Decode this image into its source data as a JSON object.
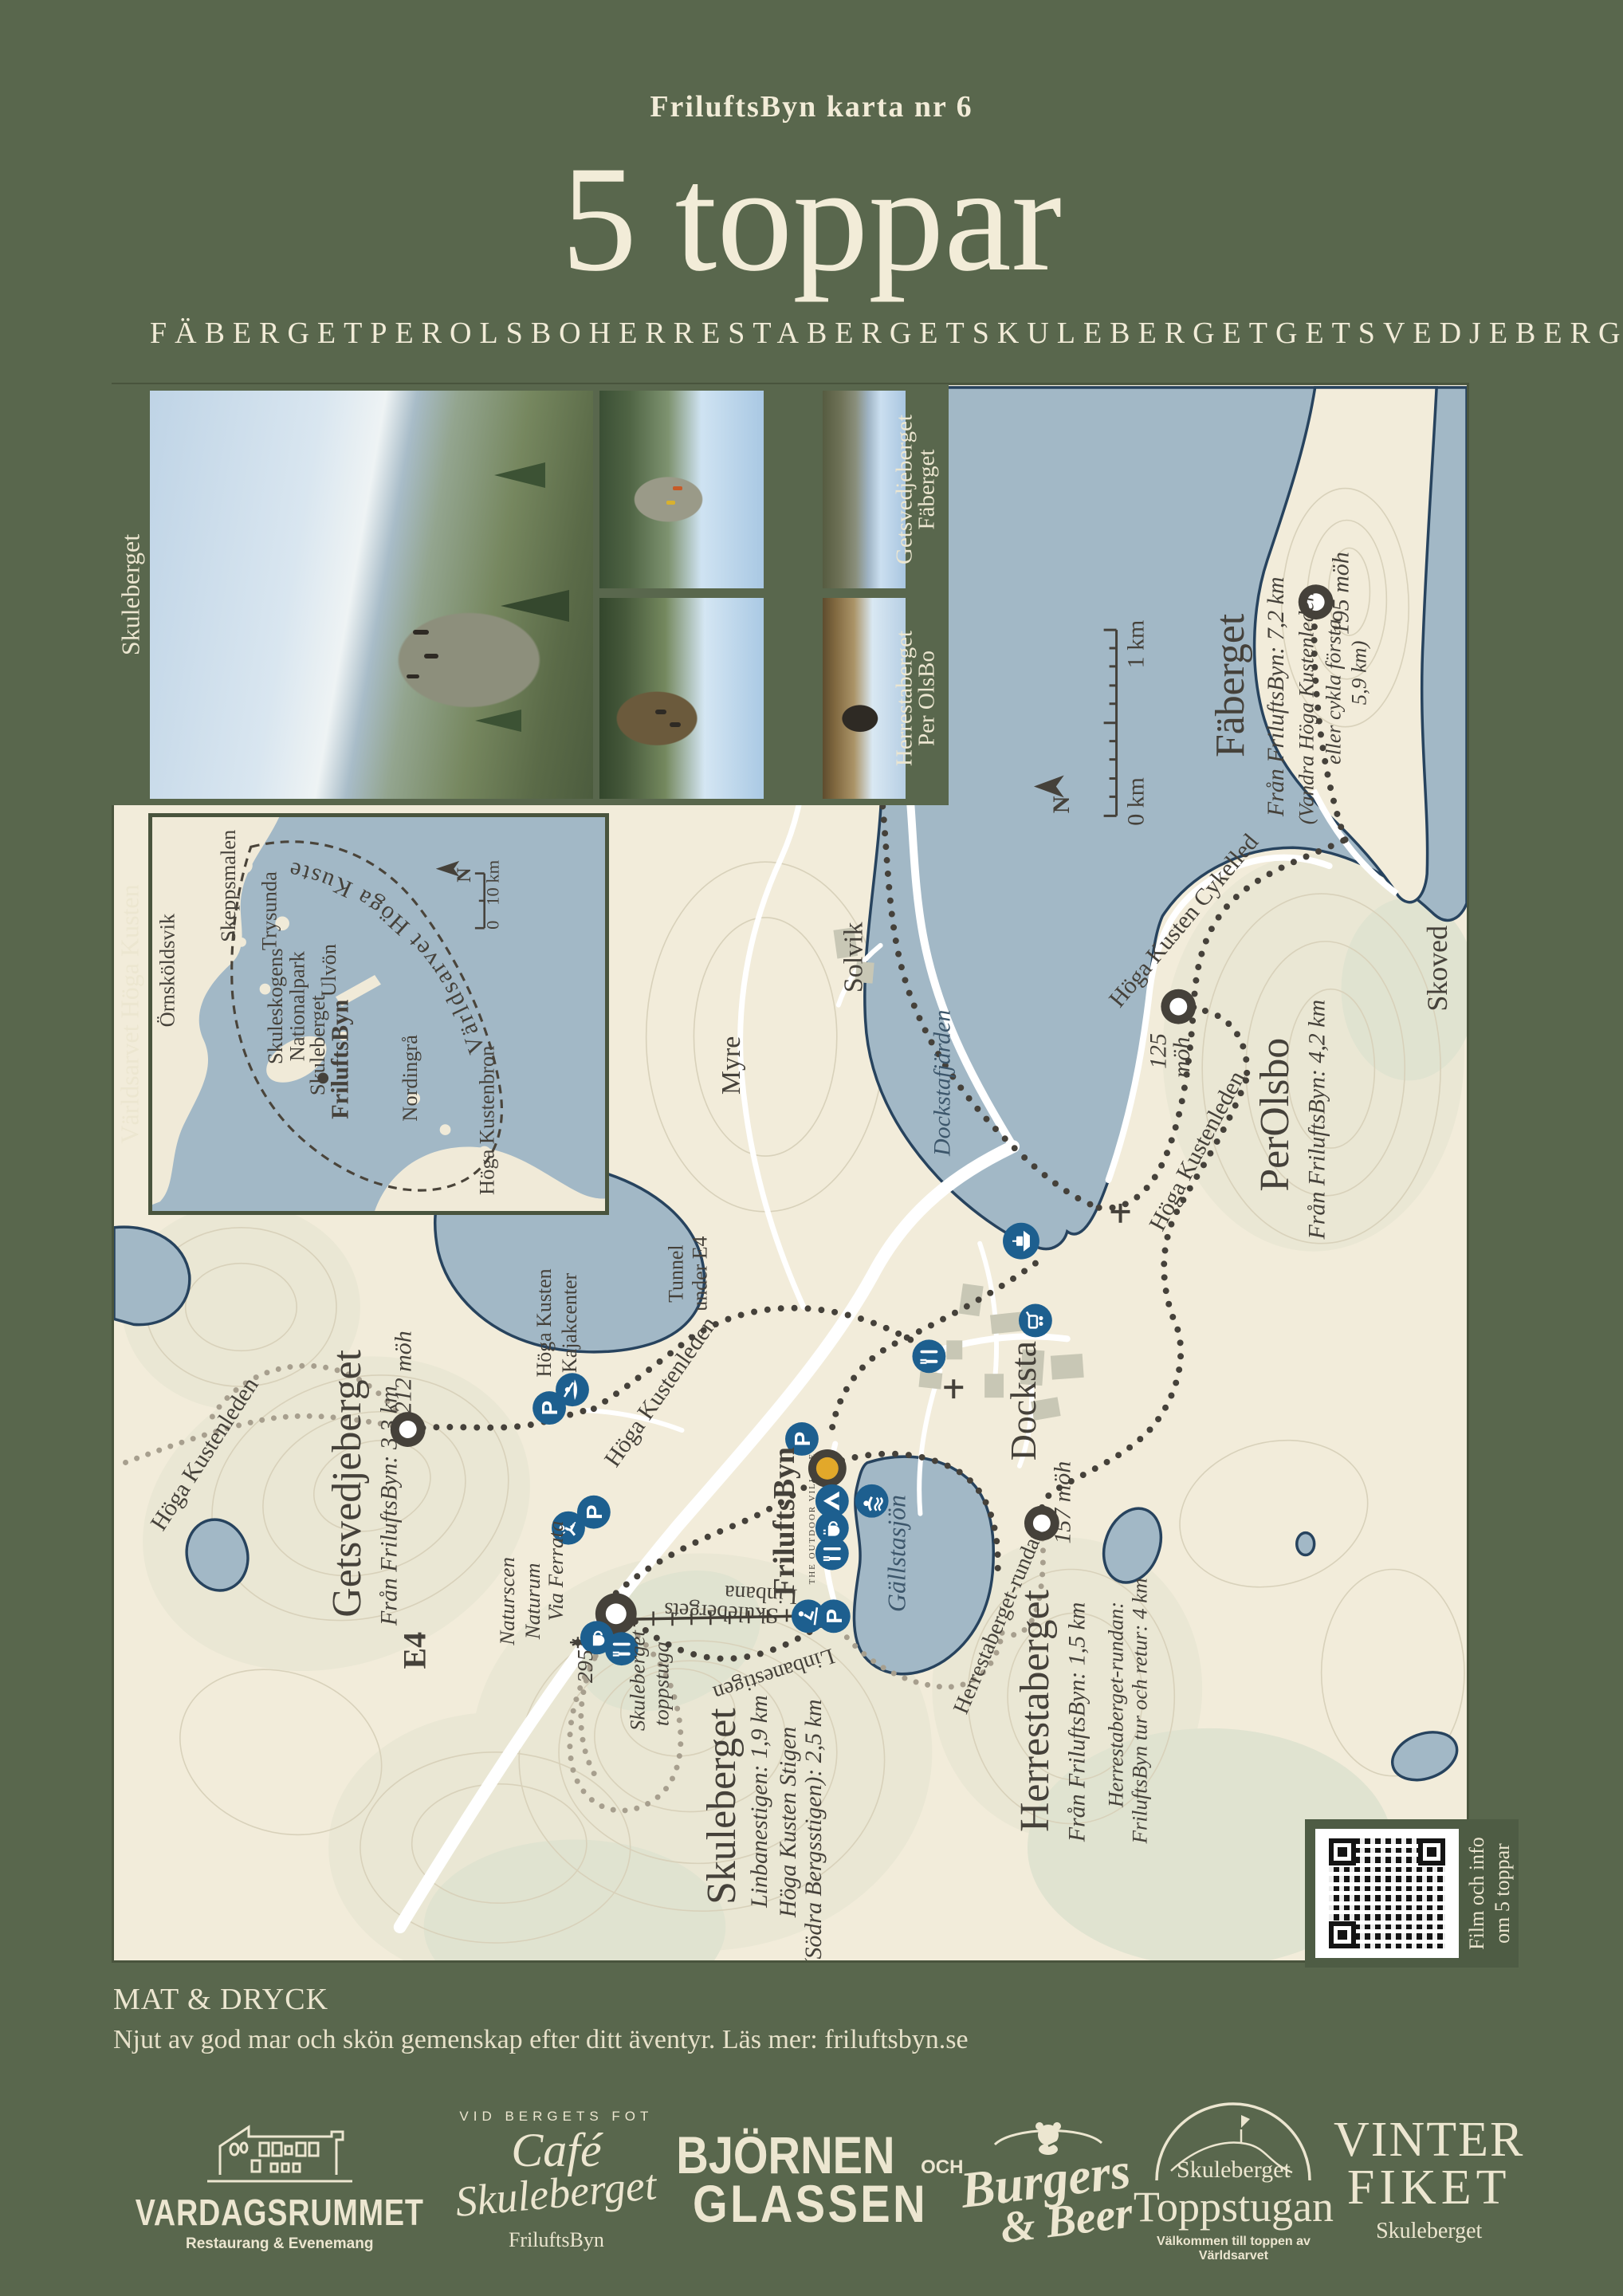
{
  "poster": {
    "kicker": "FriluftsByn karta nr 6",
    "title": "5 toppar",
    "peaks": [
      "FÄBERGET",
      "PEROLSBO",
      "HERRESTABERGET",
      "SKULEBERGET",
      "GETSVEDJEBERGET"
    ],
    "colors": {
      "green": "#59674d",
      "cream": "#efe9d3",
      "land": "#f2ecda",
      "water": "#a2b8c6",
      "trail": "#45413a",
      "blue_icon": "#1d5f8f",
      "gold": "#e2a82a"
    }
  },
  "photos": {
    "side_label": "Skuleberget",
    "col1_top": "Getsvedjeberget",
    "col1_bottom": "Herrestaberget",
    "col2_top": "Fäberget",
    "col2_bottom": "Per OlsBo"
  },
  "inset": {
    "side_label": "Världsarvet Höga Kusten",
    "heritage": "Världsarvet Höga Kusten",
    "ornskoldsvik": "Örnsköldsvik",
    "skeppsmalen": "Skeppsmalen",
    "trysunda": "Trysunda",
    "ulvon": "Ulvön",
    "skuleskogens1": "Skuleskogens",
    "skuleskogens2": "Nationalpark",
    "skuleberget": "Skuleberget",
    "friluftsbyn": "FriluftsByn",
    "nordingra": "Nordingrå",
    "kustenbron": "Höga Kustenbron",
    "north": "N",
    "scale_max": "10 km",
    "scale_min": "0"
  },
  "map": {
    "faberget": {
      "name": "Fäberget",
      "from": "Från FriluftsByn: 7,2 km",
      "note1": "(Vandra Höga Kustenleden",
      "note2": "eller cykla första",
      "note3": "5,9 km)",
      "elev": "195 möh"
    },
    "perolsbo": {
      "name": "PerOlsbo",
      "from": "Från FriluftsByn: 4,2 km",
      "elev1": "125",
      "elev2": "möh"
    },
    "getsvedjeberget": {
      "name": "Getsvedjeberget",
      "from": "Från FriluftsByn: 3,3 km",
      "elev": "212 möh"
    },
    "skuleberget": {
      "name": "Skuleberget",
      "info1": "Linbanestigen: 1,9 km",
      "info2": "Höga Kusten Stigen",
      "info3": "(Södra Bergsstigen): 2,5 km",
      "elev": "295",
      "hut1": "Skuleberget",
      "hut2": "toppstuga"
    },
    "herrestaberget": {
      "name": "Herrestaberget",
      "from": "Från FriluftsByn: 1,5 km",
      "loop1": "Herrestaberget-rundan:",
      "loop2": "FriluftsByn tur och retur: 4 km",
      "elev": "157 möh"
    },
    "friluftsbyn": {
      "name": "FriluftsByn",
      "sub": "THE OUTDOOR VILLAGE"
    },
    "places": {
      "docksta": "Docksta",
      "skoved": "Skoved",
      "solvik": "Solvik",
      "myre": "Myre",
      "e4": "E4"
    },
    "water": {
      "dockstafjarden": "Dockstafjärden",
      "gallstasjon": "Gällstasjön"
    },
    "trails": {
      "cykelled": "Höga Kusten Cykelled",
      "kustenleden_a": "Höga Kustenleden",
      "kustenleden_b": "Höga Kustenleden",
      "kustenleden_c": "Höga Kustenleden",
      "linbana1": "Skulebergets",
      "linbana2": "Linbana",
      "linbanestigen": "Linbanestigen",
      "rundan": "Herrestaberget-rundan",
      "tunnel1": "Tunnel",
      "tunnel2": "under E4",
      "kajak1": "Höga Kusten",
      "kajak2": "Kajakcenter",
      "naturscen1": "Naturscen",
      "naturscen2": "Naturum",
      "viaferrata": "Via Ferrata"
    },
    "scale_max": "1 km",
    "scale_min": "0 km",
    "north": "N"
  },
  "qr": {
    "line1": "Film och info",
    "line2": "om 5 toppar"
  },
  "footer": {
    "heading": "MAT & DRYCK",
    "body": "Njut av god mar och skön gemenskap efter ditt äventyr.  Läs mer: friluftsbyn.se"
  },
  "logos": {
    "vardagsrummet": {
      "name": "VARDAGSRUMMET",
      "tagline": "Restaurang & Evenemang"
    },
    "cafe": {
      "arc": "VID BERGETS FOT",
      "script1": "Café",
      "script2": "Skuleberget",
      "sub": "FriluftsByn"
    },
    "bjornen": {
      "line1": "BJÖRNEN",
      "och": "OCH",
      "line2": "GLASSEN"
    },
    "burgers": {
      "line1": "Burgers",
      "line2": "& Beer"
    },
    "toppstugan": {
      "top": "Skuleberget",
      "name": "Toppstugan",
      "tagline": "Välkommen till toppen av Världsarvet"
    },
    "vinterfiket": {
      "line1": "VINTER",
      "line2": "FIKET",
      "sub": "Skuleberget"
    }
  }
}
